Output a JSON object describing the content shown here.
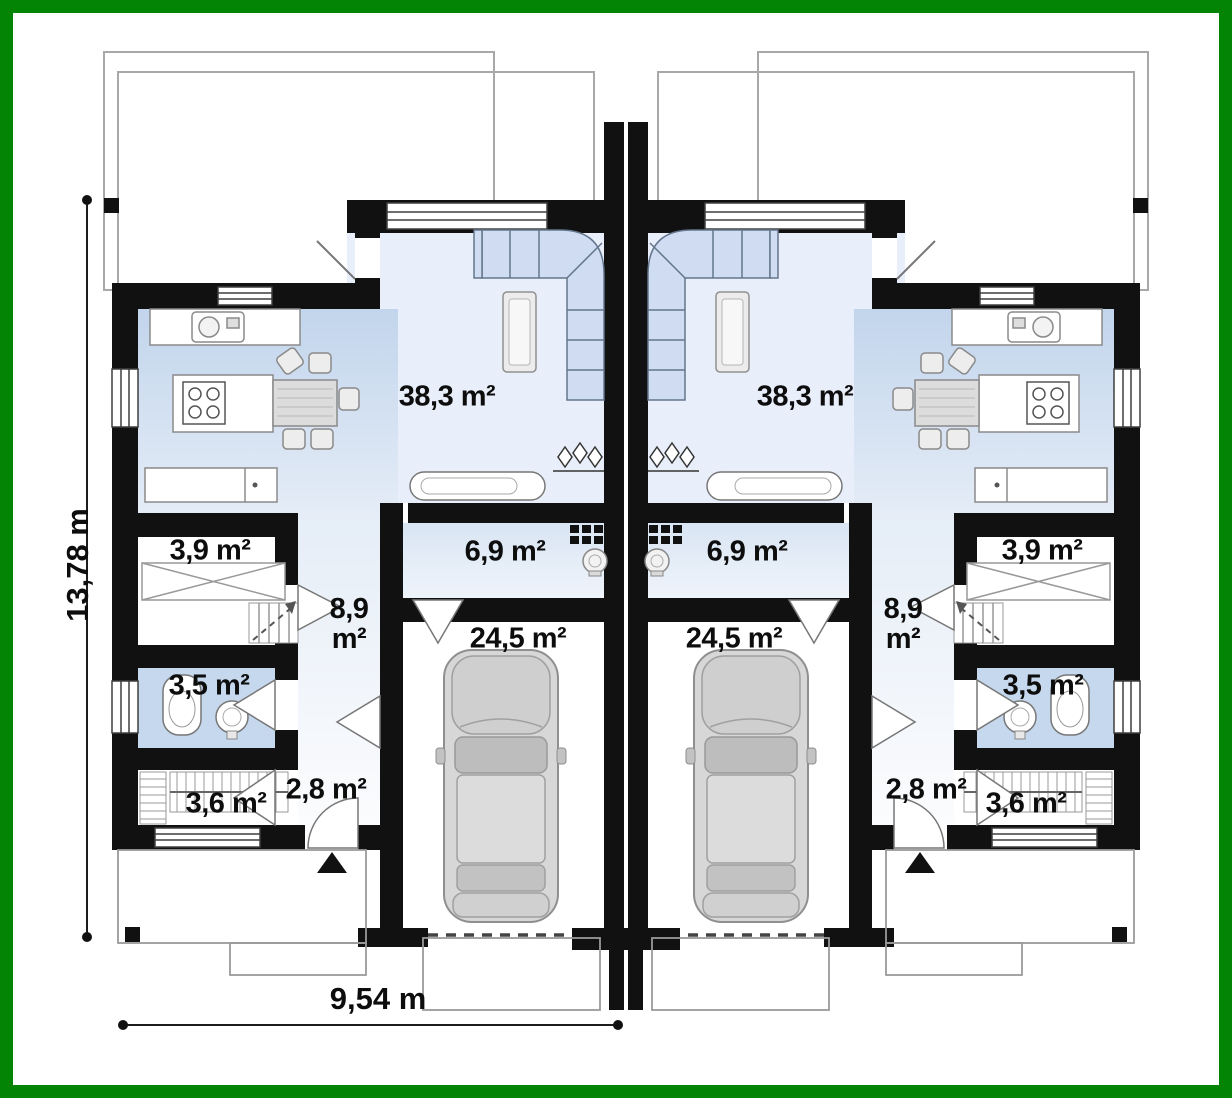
{
  "page": {
    "type": "architectural-floor-plan",
    "subject": "semi-detached twin house, ground floor with garages"
  },
  "dimensions": {
    "total_height": "13,78 m",
    "unit_width": "9,54 m"
  },
  "units": [
    {
      "side": "left",
      "rooms": {
        "living_room": "38,3 m²",
        "hall": "6,9 m²",
        "garage": "24,5 m²",
        "corridor_value": "8,9",
        "corridor_unit": "m²",
        "storage": "3,9 m²",
        "bathroom": "3,5 m²",
        "wardrobe": "3,6 m²",
        "vestibule": "2,8 m²"
      }
    },
    {
      "side": "right",
      "rooms": {
        "living_room": "38,3 m²",
        "hall": "6,9 m²",
        "garage": "24,5 m²",
        "corridor_value": "8,9",
        "corridor_unit": "m²",
        "storage": "3,9 m²",
        "bathroom": "3,5 m²",
        "wardrobe": "3,6 m²",
        "vestibule": "2,8 m²"
      }
    }
  ],
  "colors": {
    "frame_green": "#048404",
    "wall_black": "#111111",
    "floor_light_blue": "#e9effa",
    "floor_medium_blue": "#c6d8ee",
    "sofa_blue": "#cfdcf2",
    "car_gray": "#d7d7d7",
    "dimension_line": "#1c1c1c"
  }
}
